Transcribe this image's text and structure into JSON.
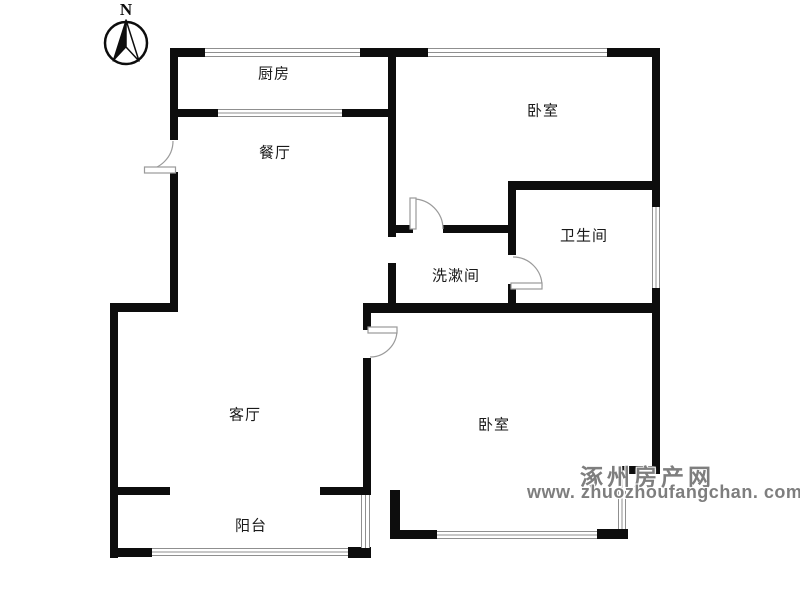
{
  "compass": {
    "label": "N"
  },
  "rooms": [
    {
      "id": "kitchen",
      "label": "厨房"
    },
    {
      "id": "dining-room",
      "label": "餐厅"
    },
    {
      "id": "bedroom-top",
      "label": "卧室"
    },
    {
      "id": "bathroom",
      "label": "卫生间"
    },
    {
      "id": "washroom",
      "label": "洗漱间"
    },
    {
      "id": "living-room",
      "label": "客厅"
    },
    {
      "id": "bedroom-bottom",
      "label": "卧室"
    },
    {
      "id": "balcony",
      "label": "阳台"
    }
  ],
  "watermark": {
    "site_name": "涿州房产网",
    "url": "www. zhuozhoufangchan. com"
  },
  "colors": {
    "wall": "#0d0d0d",
    "window_line": "#8f8f8f",
    "door_line": "#9a9a9a",
    "label_text": "#1a1a1a",
    "watermark_gray": "#7e7e7e",
    "background": "#ffffff"
  }
}
